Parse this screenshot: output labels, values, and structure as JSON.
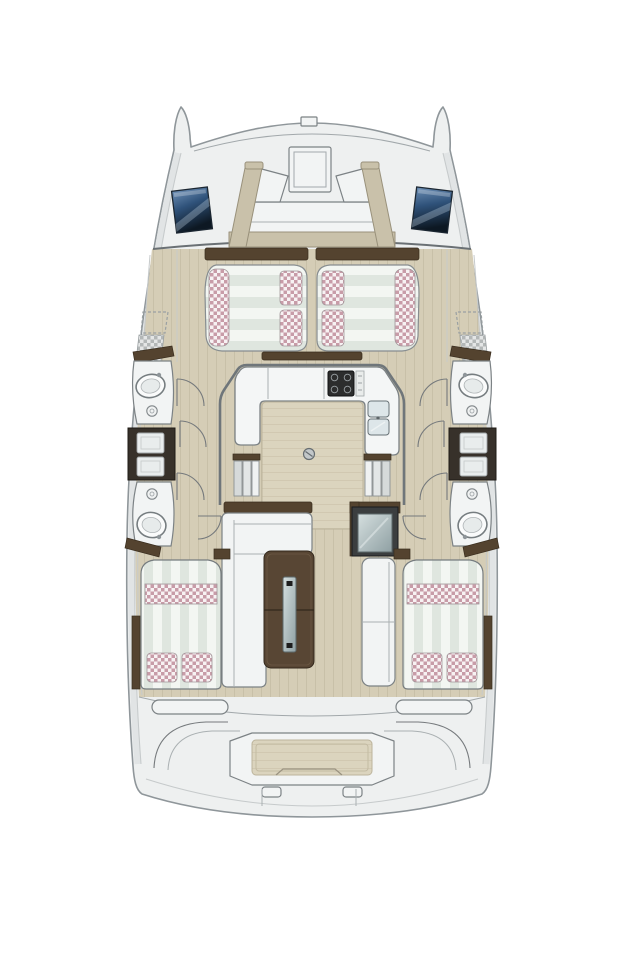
{
  "diagram": {
    "title": "Catamaran interior layout floor plan, top-down view, bow at top",
    "type": "boat-deck-floor-plan",
    "visible_text": "none"
  },
  "palette": {
    "background": "#ffffff",
    "hull": "#eef0f0",
    "hull_outline": "#8f969a",
    "deck_wood": "#d5cdb6",
    "deck_wood_grain": "#c3bba2",
    "seat_back_beige": "#c9c1aa",
    "cushion_white": "#f3f6f2",
    "cushion_stripe": "#dfe6df",
    "pillow_pink": "#c08d9b",
    "checker_gray": "#aeb2b2",
    "wood_dark": "#584634",
    "wood_trim": "#54432f",
    "counter_white": "#f4f6f6",
    "stove_black": "#2c2d2d",
    "sink_steel": "#dde6e9",
    "fixture_white": "#f2f4f4",
    "line_gray": "#7c8285",
    "window_blue_top": "#6d8fb5",
    "window_blue_mid": "#2f527a",
    "window_blue_bottom": "#0d1823",
    "glass_light": "#d5dfdf",
    "glass_dark": "#8fa0a3"
  },
  "regions": {
    "bow": {
      "hatches": 1,
      "deck_windows": 2,
      "mast_fitting": 1
    },
    "forward_cockpit": {
      "seating": "U-shaped bench with beige backrests"
    },
    "forward_sunpad": {
      "cushions": 2,
      "accent_pillows": 4,
      "accent_side_bands": 2
    },
    "galley": {
      "layout": "U-shaped counter",
      "stove_burners": 4,
      "sink_basins": 2,
      "floor_mat": 1,
      "deck_drain": 1
    },
    "companionways": {
      "count": 2,
      "treads_each": 3
    },
    "port_hull": {
      "wash_basins": 2,
      "toilets": 2,
      "vanity_drawers": 2,
      "door_swings": 3
    },
    "starboard_hull": {
      "wash_basins": 2,
      "toilets": 2,
      "vanity_drawers": 2,
      "door_swings": 3
    },
    "salon": {
      "sofa": "L-shaped",
      "table_leaves": 2,
      "cooler_unit": 1,
      "bench_seats": 1
    },
    "aft_cabins": {
      "count": 2,
      "double_berths": 2,
      "pillows_per_berth": 2
    },
    "aft_deck": {
      "side_steps": 2,
      "center_step_pad": 1,
      "transom_seams": 2
    }
  }
}
